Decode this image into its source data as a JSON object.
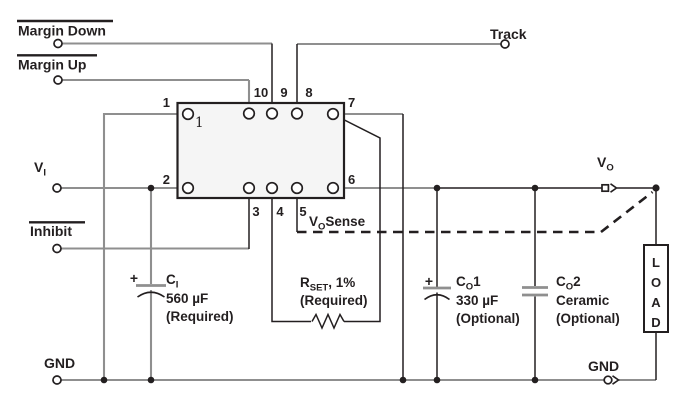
{
  "labels": {
    "margin_down": "Margin Down",
    "margin_up": "Margin Up",
    "track": "Track",
    "inhibit": "Inhibit",
    "gnd_left": "GND",
    "gnd_right": "GND",
    "vin": {
      "main": "V",
      "sub": "I"
    },
    "vout": {
      "main": "V",
      "sub": "O"
    },
    "vo_sense": {
      "main": "V",
      "sub": "O",
      "suffix": "Sense"
    }
  },
  "module": {
    "pin_numbers": [
      "1",
      "2",
      "3",
      "4",
      "5",
      "6",
      "7",
      "8",
      "9",
      "10"
    ],
    "pin1_marker": "1"
  },
  "components": {
    "c_in": {
      "plus": "+",
      "ref": {
        "main": "C",
        "sub": "I"
      },
      "value": "560 µF",
      "note": "(Required)"
    },
    "r_set": {
      "ref": {
        "main": "R",
        "sub": "SET",
        "suffix": ", 1%"
      },
      "note": "(Required)"
    },
    "c_out1": {
      "plus": "+",
      "ref": {
        "main": "C",
        "sub": "O",
        "suffix": "1"
      },
      "value": "330 µF",
      "note": "(Optional)"
    },
    "c_out2": {
      "ref": {
        "main": "C",
        "sub": "O",
        "suffix": "2"
      },
      "value": "Ceramic",
      "note": "(Optional)"
    },
    "load": {
      "letters": [
        "L",
        "O",
        "A",
        "D"
      ]
    }
  },
  "colors": {
    "ink": "#231f20",
    "wire": "#8f8f8f",
    "plate": "#8f8f8f",
    "module_fill": "#f5f5f5"
  }
}
